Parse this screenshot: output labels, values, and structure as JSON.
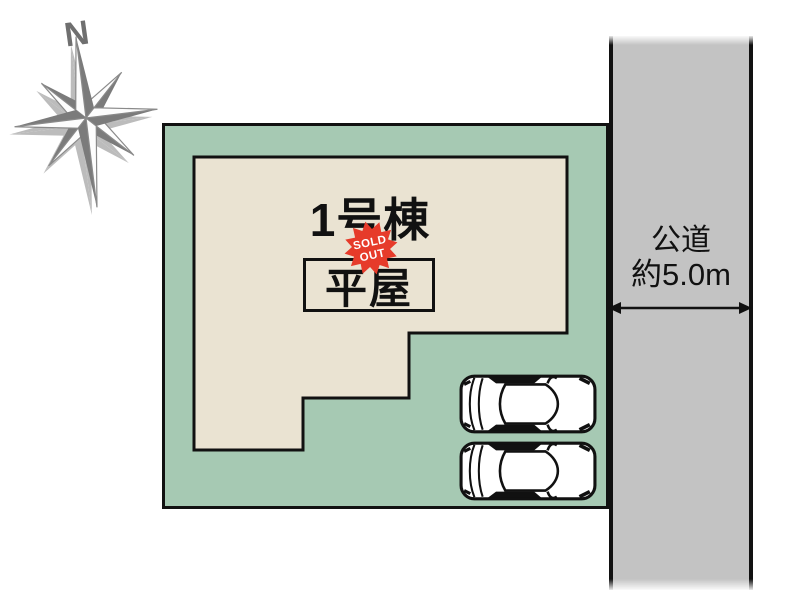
{
  "compass": {
    "north_label": "N"
  },
  "plot": {
    "unit_label": "1号棟",
    "building_type": "平屋",
    "badge": {
      "line1": "SOLD",
      "line2": "OUT"
    }
  },
  "road": {
    "name": "公道",
    "width": "約5.0m"
  },
  "parking": {
    "car_count": 2
  },
  "colors": {
    "plot_green": "#a6c9b3",
    "building_beige": "#eae3d2",
    "road_gray": "#c3c3c3",
    "badge_red": "#e63b2a",
    "outline_black": "#111111",
    "compass_gray": "#7b7b7b",
    "compass_shadow": "#bcbcbc"
  }
}
